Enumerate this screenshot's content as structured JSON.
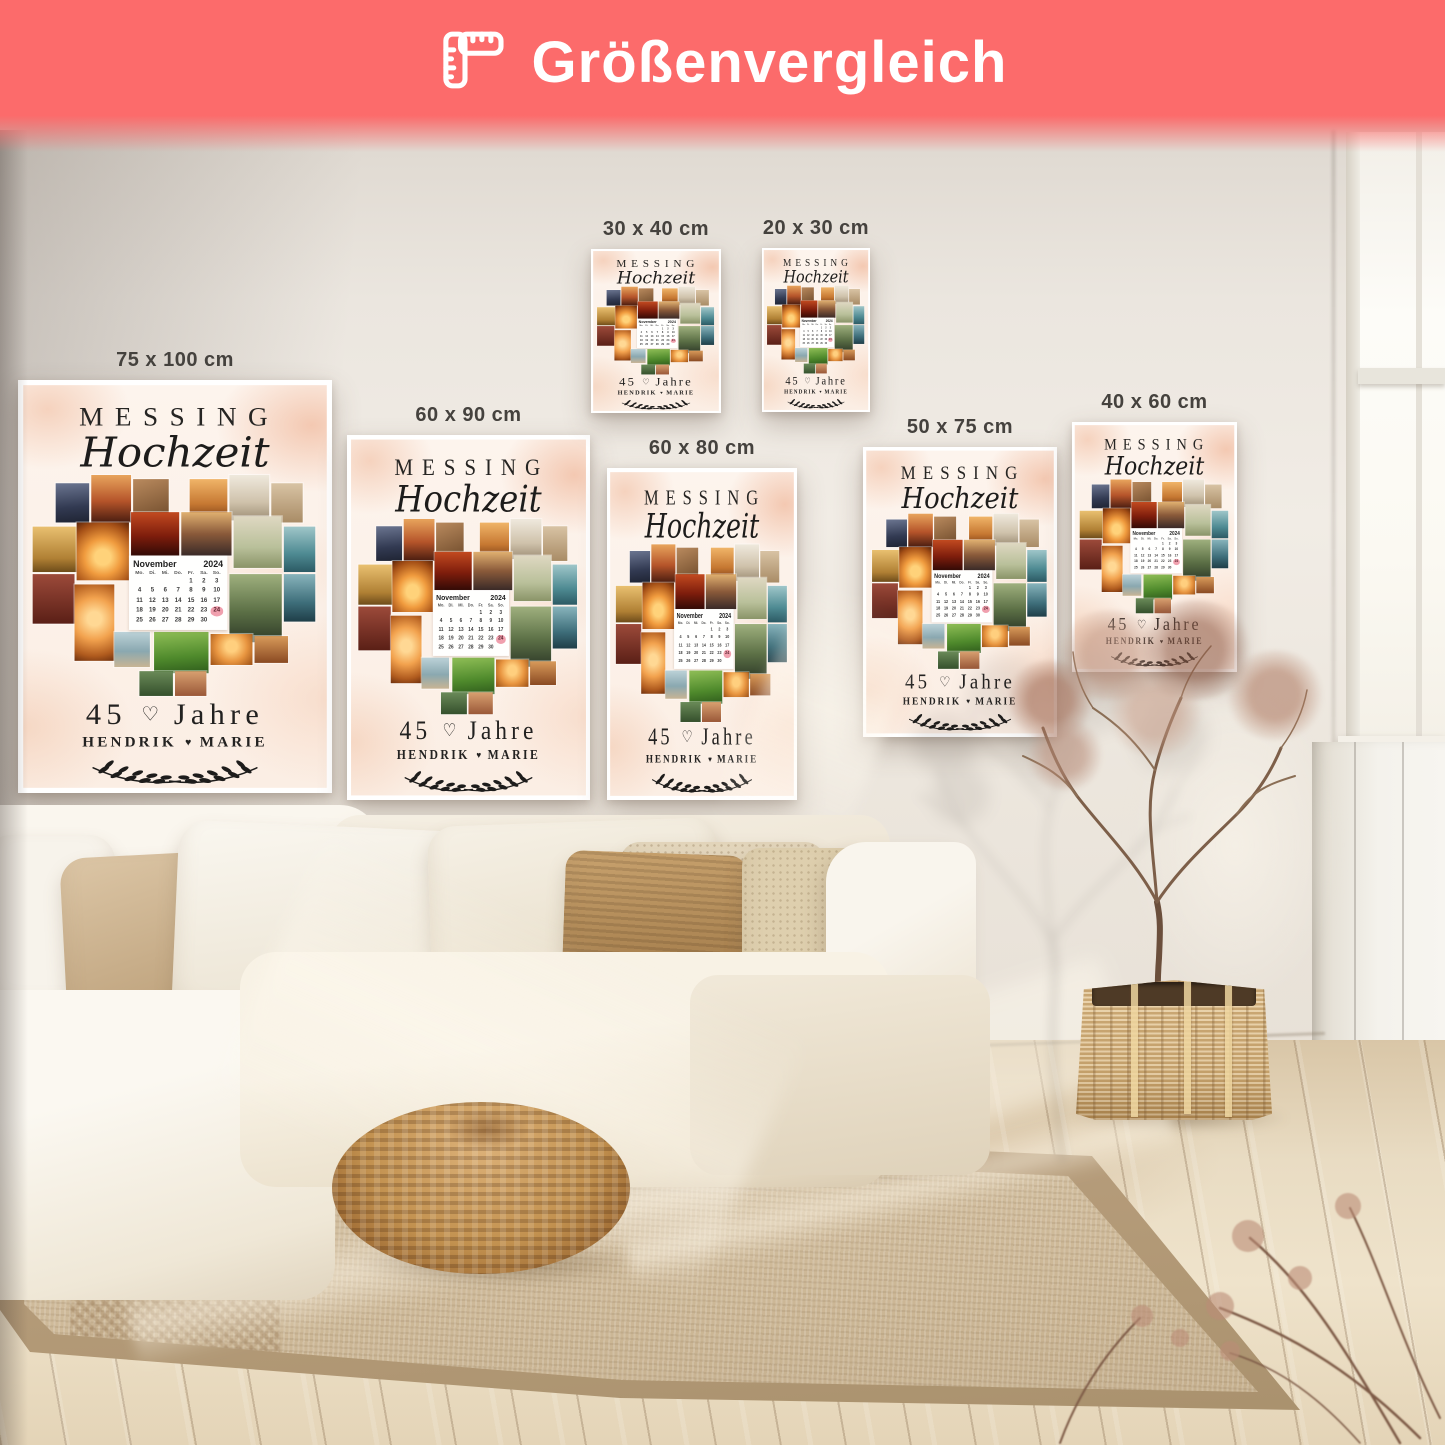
{
  "banner": {
    "title": "Größenvergleich",
    "icon": "ruler-icon",
    "bg_color": "#fc6b6b",
    "text_color": "#ffffff"
  },
  "poster_design": {
    "title_line1": "MESSING",
    "title_line2": "Hochzeit",
    "years_value": "45",
    "years_separator": "♡",
    "years_label": "Jahre",
    "name_left": "HENDRIK",
    "name_separator": "♥",
    "name_right": "MARIE",
    "calendar": {
      "month": "November",
      "year": "2024",
      "day_headers": [
        "Mo.",
        "Di.",
        "Mi.",
        "Do.",
        "Fr.",
        "Sa.",
        "So."
      ],
      "weeks": [
        [
          "",
          "",
          "",
          "",
          "1",
          "2",
          "3"
        ],
        [
          "4",
          "5",
          "6",
          "7",
          "8",
          "9",
          "10"
        ],
        [
          "11",
          "12",
          "13",
          "14",
          "15",
          "16",
          "17"
        ],
        [
          "18",
          "19",
          "20",
          "21",
          "22",
          "23",
          "24"
        ],
        [
          "25",
          "26",
          "27",
          "28",
          "29",
          "30",
          ""
        ]
      ],
      "highlighted_day": "24",
      "highlight_color": "#f0a0ae"
    },
    "heart_tiles": [
      {
        "x": 36,
        "y": 100,
        "w": 32,
        "h": 38,
        "kind": "dusk"
      },
      {
        "x": 70,
        "y": 92,
        "w": 38,
        "h": 46,
        "kind": "pier"
      },
      {
        "x": 110,
        "y": 96,
        "w": 34,
        "h": 40,
        "kind": "guitar"
      },
      {
        "x": 164,
        "y": 96,
        "w": 36,
        "h": 40,
        "kind": "golden"
      },
      {
        "x": 202,
        "y": 92,
        "w": 38,
        "h": 44,
        "kind": "bride"
      },
      {
        "x": 242,
        "y": 100,
        "w": 30,
        "h": 38,
        "kind": "sand"
      },
      {
        "x": 14,
        "y": 142,
        "w": 42,
        "h": 44,
        "kind": "meadow"
      },
      {
        "x": 56,
        "y": 138,
        "w": 50,
        "h": 56,
        "kind": "chairs"
      },
      {
        "x": 108,
        "y": 128,
        "w": 46,
        "h": 42,
        "kind": "reddusk"
      },
      {
        "x": 156,
        "y": 128,
        "w": 48,
        "h": 42,
        "kind": "duskpair"
      },
      {
        "x": 206,
        "y": 132,
        "w": 46,
        "h": 50,
        "kind": "dune"
      },
      {
        "x": 254,
        "y": 142,
        "w": 30,
        "h": 44,
        "kind": "teal"
      },
      {
        "x": 14,
        "y": 188,
        "w": 40,
        "h": 48,
        "kind": "redlove"
      },
      {
        "x": 54,
        "y": 198,
        "w": 38,
        "h": 74,
        "kind": "flamingo"
      },
      {
        "x": 202,
        "y": 188,
        "w": 50,
        "h": 66,
        "kind": "wedwalk"
      },
      {
        "x": 254,
        "y": 188,
        "w": 30,
        "h": 46,
        "kind": "ocean"
      },
      {
        "x": 92,
        "y": 244,
        "w": 34,
        "h": 34,
        "kind": "beach"
      },
      {
        "x": 130,
        "y": 244,
        "w": 52,
        "h": 40,
        "kind": "green"
      },
      {
        "x": 184,
        "y": 246,
        "w": 40,
        "h": 30,
        "kind": "hands"
      },
      {
        "x": 226,
        "y": 248,
        "w": 32,
        "h": 26,
        "kind": "fest"
      },
      {
        "x": 116,
        "y": 282,
        "w": 32,
        "h": 24,
        "kind": "tip1"
      },
      {
        "x": 150,
        "y": 282,
        "w": 30,
        "h": 24,
        "kind": "tip2"
      }
    ]
  },
  "posters": [
    {
      "size_label": "75 x 100 cm",
      "left": 18,
      "top": 380,
      "width": 314,
      "height": 413
    },
    {
      "size_label": "60 x 90 cm",
      "left": 347,
      "top": 435,
      "width": 243,
      "height": 365
    },
    {
      "size_label": "30 x 40 cm",
      "left": 591,
      "top": 249,
      "width": 130,
      "height": 164
    },
    {
      "size_label": "20 x 30 cm",
      "left": 762,
      "top": 248,
      "width": 108,
      "height": 164
    },
    {
      "size_label": "60 x 80 cm",
      "left": 607,
      "top": 468,
      "width": 190,
      "height": 332
    },
    {
      "size_label": "50 x 75 cm",
      "left": 863,
      "top": 447,
      "width": 194,
      "height": 290
    },
    {
      "size_label": "40 x 60 cm",
      "left": 1072,
      "top": 422,
      "width": 165,
      "height": 250
    }
  ],
  "room": {
    "wall_color": "#ece7e0",
    "floor_color": "#e9dcc3",
    "rug_color": "#cdb897",
    "sofa_color": "#f6f1e6",
    "pouf_color": "#c2914f",
    "basket_color": "#d8b67e"
  }
}
